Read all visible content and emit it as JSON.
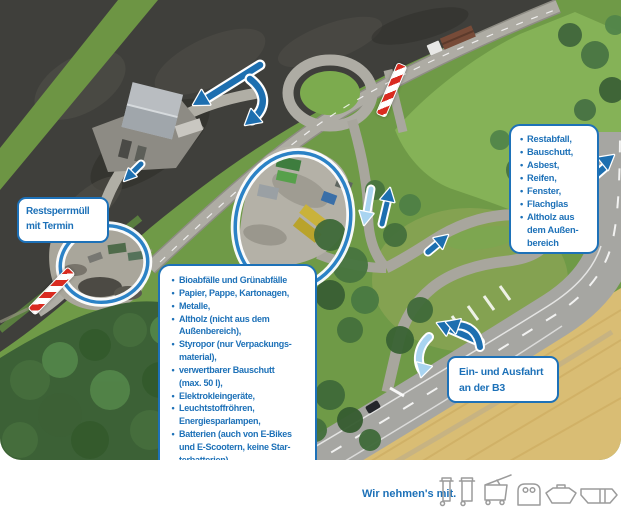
{
  "ui": {
    "bullet": "•"
  },
  "labels": {
    "appointment_box": "Restsperrmüll\nmit Termin",
    "exit_box": "Ein- und Ausfahrt\nan der B3"
  },
  "accepted_box": {
    "items": [
      "Bioabfälle und Grünabfälle",
      "Papier, Pappe, Kartonagen,",
      "Metalle,",
      "Altholz (nicht aus dem\nAußenbereich),",
      "Styropor (nur Verpackungs-\nmaterial),",
      "verwertbarer Bauschutt\n(max. 50 l),",
      "Elektrokleingeräte,",
      "Leuchtstoffröhren,\nEnergiesparlampen,",
      "Batterien (auch von E-Bikes\nund E-Scootern, keine Star-\nterbatterien),",
      "Druckerpatronen,",
      "CDs und DVDs,",
      "Altkleider und Schuhe"
    ]
  },
  "restricted_box": {
    "items": [
      "Restabfall,",
      "Bauschutt,",
      "Asbest,",
      "Reifen,",
      "Fenster,",
      "Flachglas",
      "Altholz aus\ndem Außen-\nbereich"
    ]
  },
  "footer": {
    "tagline": "Wir nehmen's mit.",
    "icons": [
      "waste-bin-small-icon",
      "waste-bin-large-icon",
      "wheeled-container-open-icon",
      "igloo-container-icon",
      "skip-container-icon",
      "rolloff-container-icon"
    ]
  },
  "colors": {
    "accent": "#1d71b8",
    "arrow-blue": "#1d6fb0",
    "arrow-light": "#a9d4f0",
    "ring-blue": "#2b82c6",
    "barrier-red": "#d92b20",
    "icon-gray": "#9b9b9b"
  }
}
